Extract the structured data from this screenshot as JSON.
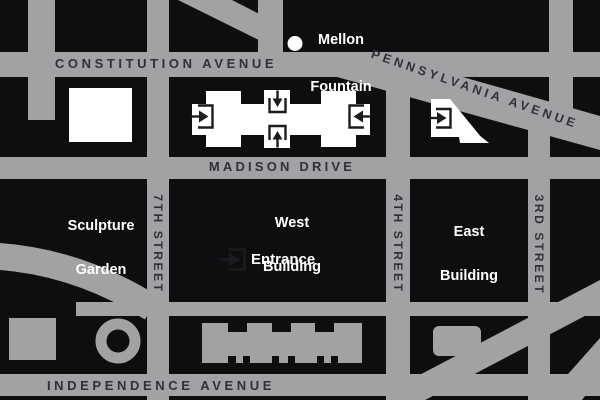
{
  "colors": {
    "street_gray": "#a1a2a4",
    "block_black": "#0d0e10",
    "building_white": "#ffffff",
    "gray_building": "#a1a2a4",
    "street_label_dark": "#342f36",
    "white_label": "#ffffff",
    "icon_dark": "#1c1b1e"
  },
  "street_labels": {
    "constitution": "CONSTITUTION AVENUE",
    "madison": "MADISON DRIVE",
    "independence": "INDEPENDENCE AVENUE",
    "pennsylvania": "PENNSYLVANIA AVENUE",
    "seventh_street": "7TH STREET",
    "fourth_street": "4TH STREET",
    "third_street": "3RD STREET"
  },
  "place_labels": {
    "mellon_line1": "Mellon",
    "mellon_line2": "Fountain",
    "sculpture_line1": "Sculpture",
    "sculpture_line2": "Garden",
    "west_line1": "West",
    "west_line2": "Building",
    "east_line1": "East",
    "east_line2": "Building",
    "entrance": "Entrance"
  },
  "icons": {
    "west_left_entrance": "arrow-into-doorway-icon",
    "west_north_entrance": "arrow-into-doorway-icon",
    "west_south_entrance": "arrow-into-doorway-icon",
    "west_right_entrance": "arrow-into-doorway-icon",
    "east_entrance": "arrow-into-doorway-icon",
    "main_entrance_marker": "arrow-into-doorway-icon",
    "mellon_fountain_marker": "white-dot-icon"
  }
}
